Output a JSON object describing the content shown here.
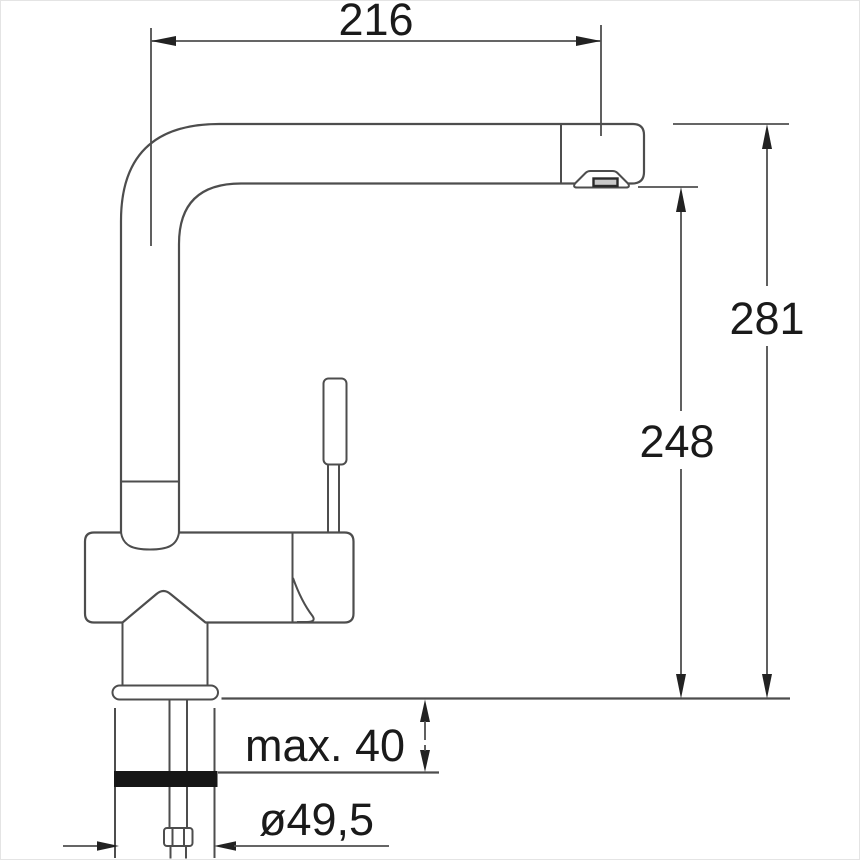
{
  "drawing": {
    "type": "technical-dimension-drawing",
    "subject": "single-lever kitchen faucet, side view with mounting hardware"
  },
  "dimensions": {
    "spout_reach": "216",
    "overall_height": "281",
    "outlet_height": "248",
    "mounting_thickness": "max. 40",
    "hole_diameter": "ø49,5"
  },
  "colors": {
    "background": "#ffffff",
    "outline": "#4d4d4d",
    "dimension_lines": "#4f4f4f",
    "text": "#1a1a1a",
    "arrows": "#222222",
    "seal_washer": "#161616",
    "aerator_screen": "#c9c9c9"
  }
}
